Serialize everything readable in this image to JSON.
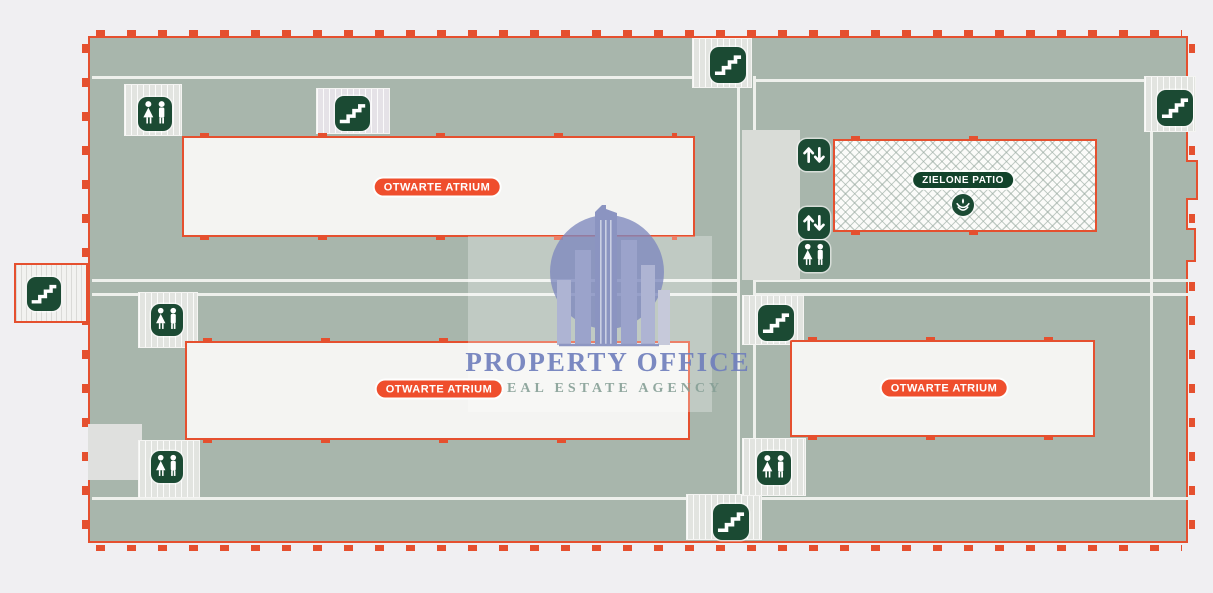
{
  "plan": {
    "atriums": [
      {
        "label": "OTWARTE ATRIUM"
      },
      {
        "label": "OTWARTE ATRIUM"
      },
      {
        "label": "OTWARTE ATRIUM"
      }
    ],
    "patio": {
      "label": "ZIELONE PATIO"
    }
  },
  "watermark": {
    "title": "PROPERTY OFFICE",
    "subtitle": "REAL ESTATE AGENCY"
  },
  "icons": [
    {
      "name": "stairs-icon",
      "glyph": "stairs"
    },
    {
      "name": "wc-icon",
      "glyph": "woman-man"
    },
    {
      "name": "elevator-icon",
      "glyph": "up-down-arrows"
    },
    {
      "name": "plant-icon",
      "glyph": "plant"
    }
  ],
  "colors": {
    "outline": "#e5502f",
    "floor": "#a8b6ac",
    "icon_green": "#1b4a33",
    "badge_red": "#ef4e2d",
    "badge_green": "#12432b",
    "watermark_blue": "#7d89c4",
    "watermark_green_text": "#859e96",
    "background": "#f0eff2"
  }
}
